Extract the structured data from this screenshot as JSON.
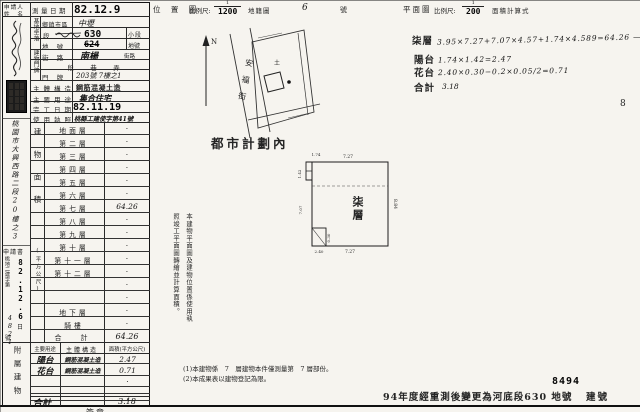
{
  "header": {
    "location_map": "位 置 圖",
    "scale_label1": "比例尺:",
    "scale1_num": "1",
    "scale1_den": "1200",
    "cadastral_map": "地籍圖",
    "cadastral_no": "6",
    "cadastral_suffix": "號",
    "plan_label": "平面圖",
    "scale_label2": "比例尺:",
    "scale2_num": "1",
    "scale2_den": "200",
    "area_calc": "面積計算式",
    "page_no": "8"
  },
  "applicant": {
    "label_line1": "申請人",
    "label_line2": "姓 名",
    "address": "桃園市大興西路二段20樓之3",
    "application": "申請書",
    "receipt_date": "82.12.6",
    "day": "日",
    "file_prefix": "桃地二建字第",
    "file_no": "4821",
    "no_suffix": "號"
  },
  "form": {
    "survey_date_label": "測量日期",
    "survey_date": "82.12.9",
    "site_group": "基地坐落",
    "district_label": "鄉鎮市區",
    "district_value": "中壢",
    "section_label": "段",
    "section_value": "630",
    "subsection_label": "小段",
    "lot_label": "地 號",
    "lot_value": "624",
    "lot_suffix": "地號",
    "door_group": "建物門牌",
    "street_label": "街 路",
    "street_value": "南楊",
    "street_suffix": "街路",
    "lane_label": "段　巷　弄",
    "door_label": "門 牌",
    "door_value": "203號 7樓之1",
    "structure_label": "主體構造",
    "structure_value": "鋼筋混凝土造",
    "use_label": "主要用途",
    "use_value": "集合住宅",
    "completion_label": "完工日期",
    "completion_value": "82.11.19",
    "license_label": "使用執照",
    "license_value": "桃縣工建使字第41號"
  },
  "floors": {
    "group_label": "建物面積",
    "unit_label": "(平方公尺)",
    "rows": [
      {
        "label": "地面層",
        "value": "·"
      },
      {
        "label": "第二層",
        "value": "·"
      },
      {
        "label": "第三層",
        "value": "·"
      },
      {
        "label": "第四層",
        "value": "·"
      },
      {
        "label": "第五層",
        "value": "·"
      },
      {
        "label": "第六層",
        "value": "·"
      },
      {
        "label": "第七層",
        "value": "64.26"
      },
      {
        "label": "第八層",
        "value": "·"
      },
      {
        "label": "第九層",
        "value": "·"
      },
      {
        "label": "第十層",
        "value": "·"
      },
      {
        "label": "第十一層",
        "value": "·"
      },
      {
        "label": "第十二層",
        "value": "·"
      },
      {
        "label": "",
        "value": "·"
      },
      {
        "label": "",
        "value": "·"
      },
      {
        "label": "地下層",
        "value": "·"
      },
      {
        "label": "騎樓",
        "value": "·"
      }
    ],
    "total_label": "合　計",
    "total_value": "64.26"
  },
  "annex": {
    "group_label": "附屬建物",
    "col_use": "主要用途",
    "col_structure": "主體構造",
    "col_area": "面積(平方公尺)",
    "rows": [
      {
        "use": "陽台",
        "structure": "鋼筋混凝土造",
        "area": "2.47"
      },
      {
        "use": "花台",
        "structure": "鋼筋混凝土造",
        "area": "0.71"
      },
      {
        "use": "",
        "structure": "",
        "area": "·"
      },
      {
        "use": "",
        "structure": "",
        "area": "·"
      },
      {
        "use": "",
        "structure": "",
        "area": "·"
      }
    ],
    "total_label": "合計",
    "total_value": "3.18"
  },
  "calc": {
    "floor_label": "柒層",
    "floor_expr": "3.95×7.27+7.07×4.57+1.74×4.589=64.26 —",
    "balcony_label": "陽台",
    "balcony_expr": "1.74×1.42=2.47",
    "planter_label": "花台",
    "planter_expr": "2.40×0.30−0.2×0.05/2=0.71",
    "total_label": "合計",
    "total_value": "3.18"
  },
  "map": {
    "street": "安福街",
    "north": "N",
    "mark": "土"
  },
  "plan": {
    "urban_note": "都市計劃內",
    "floor_label": "柒層",
    "dim_top": "7.27",
    "dim_bottom": "7.27",
    "dim_right": "8.84",
    "dim_left": "7.07",
    "notch_w": "1.74",
    "notch_h": "1.42",
    "planter_w": "2.40",
    "planter_h": "0.30"
  },
  "notes": {
    "side_col1": "本建物平面圖及建物位置係使用執",
    "side_col2": "照竣工平面圖轉繪並計算面積。",
    "note1": "(1)本建物係　7　層建物本件僅測量第　7 層部份。",
    "note2": "(2)本成果表以建物登記為限。",
    "resurvey": "94年度經重測後變更為河底段630 地號",
    "bldg_no_stamp": "8494",
    "bldg_no_label": "建號",
    "sig": "簽章"
  }
}
